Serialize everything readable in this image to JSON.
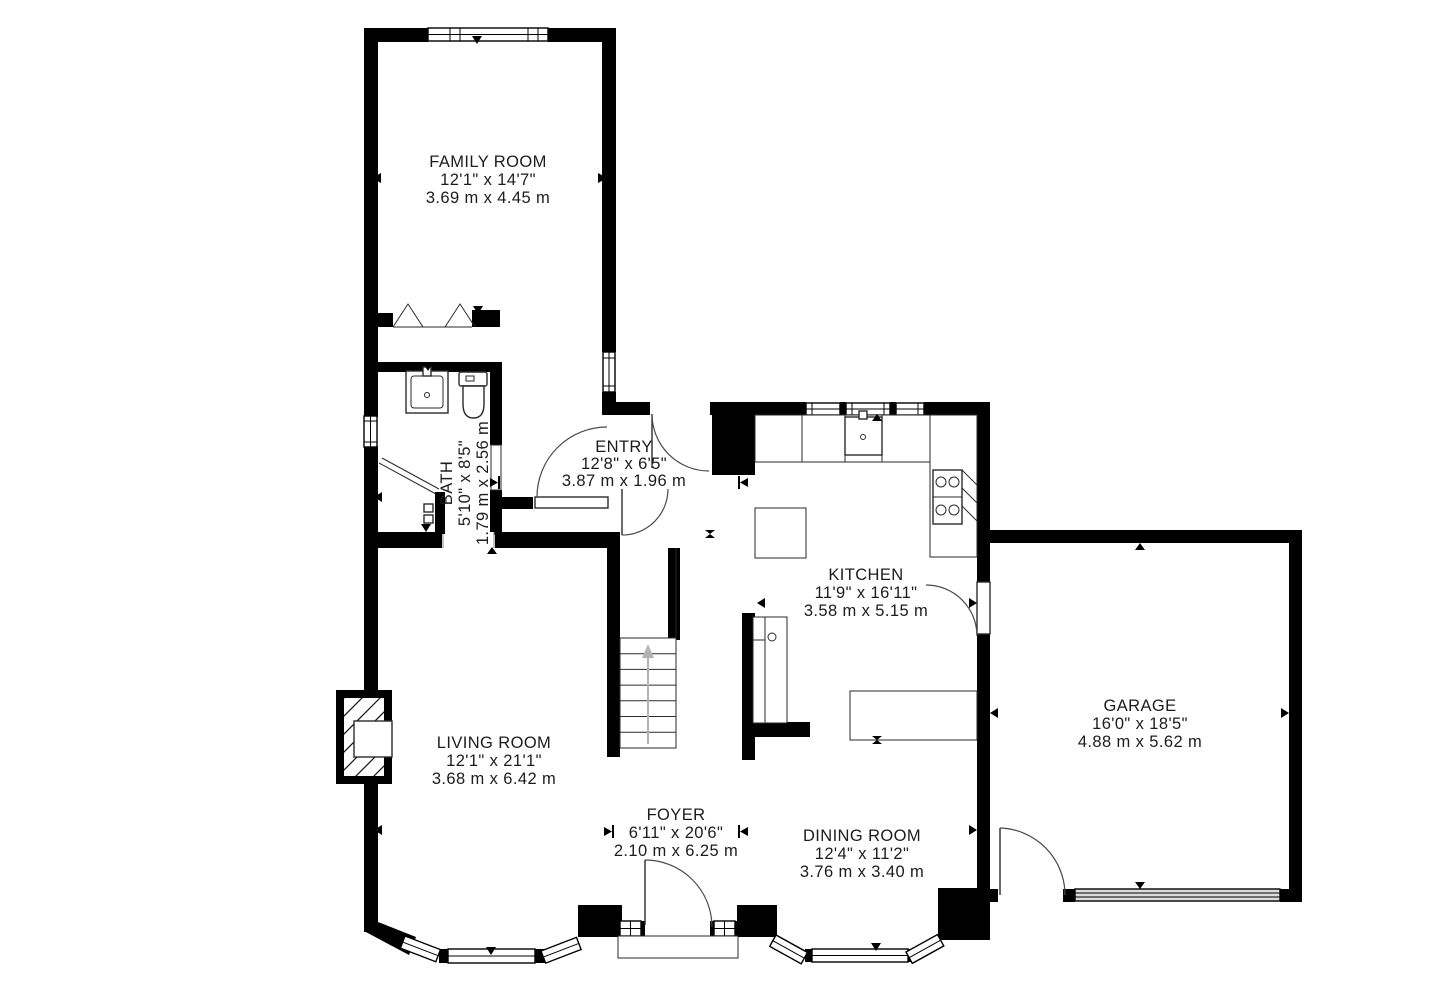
{
  "plan": {
    "title": "floor-plan",
    "colors": {
      "wall": "#000000",
      "background": "#ffffff",
      "line": "#2a2a2a",
      "stair_arrow": "#b3b3b3",
      "garage_door_fill": "#dcdcdc"
    }
  },
  "rooms": [
    {
      "id": "family-room",
      "name": "FAMILY ROOM",
      "imperial": "12'1\" x 14'7\"",
      "metric": "3.69 m x 4.45 m"
    },
    {
      "id": "bath",
      "name": "BATH",
      "imperial": "5'10\" x 8'5\"",
      "metric": "1.79 m x 2.56 m"
    },
    {
      "id": "entry",
      "name": "ENTRY",
      "imperial": "12'8\" x 6'5\"",
      "metric": "3.87 m x 1.96 m"
    },
    {
      "id": "kitchen",
      "name": "KITCHEN",
      "imperial": "11'9\" x 16'11\"",
      "metric": "3.58 m x 5.15 m"
    },
    {
      "id": "garage",
      "name": "GARAGE",
      "imperial": "16'0\" x 18'5\"",
      "metric": "4.88 m x 5.62 m"
    },
    {
      "id": "living-room",
      "name": "LIVING ROOM",
      "imperial": "12'1\" x 21'1\"",
      "metric": "3.68 m x 6.42 m"
    },
    {
      "id": "foyer",
      "name": "FOYER",
      "imperial": "6'11\" x 20'6\"",
      "metric": "2.10 m x 6.25 m"
    },
    {
      "id": "dining-room",
      "name": "DINING ROOM",
      "imperial": "12'4\" x 11'2\"",
      "metric": "3.76 m x 3.40 m"
    }
  ]
}
